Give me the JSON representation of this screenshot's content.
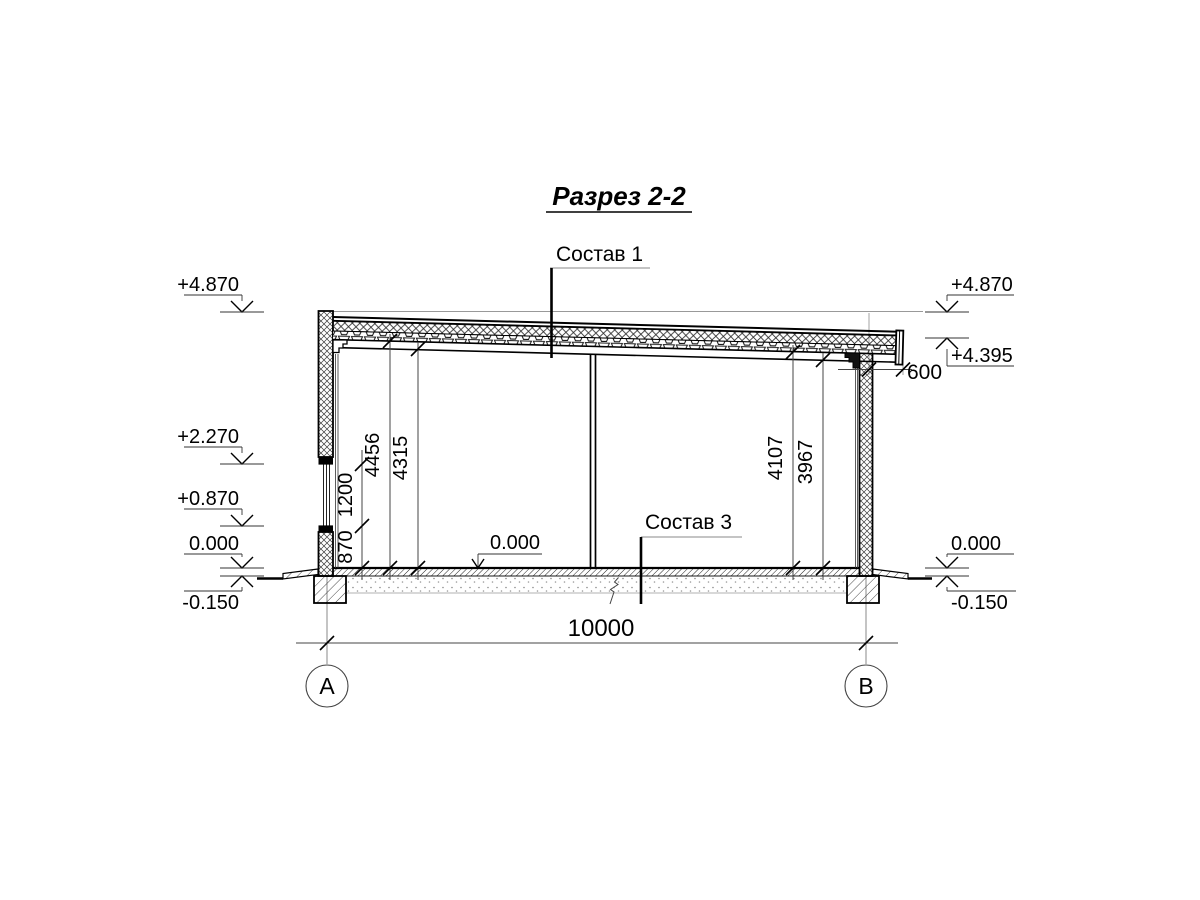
{
  "title": "Разрез 2-2",
  "callouts": {
    "roof_assembly": "Состав 1",
    "floor_assembly": "Состав 3"
  },
  "elevation_marks": {
    "left": [
      {
        "value": "+4.870"
      },
      {
        "value": "+2.270"
      },
      {
        "value": "+0.870"
      },
      {
        "value": "0.000"
      },
      {
        "value": "-0.150"
      }
    ],
    "right": [
      {
        "value": "+4.870"
      },
      {
        "value": "+4.395"
      },
      {
        "value": "0.000"
      },
      {
        "value": "-0.150"
      }
    ],
    "interior_floor": "0.000"
  },
  "dimensions": {
    "window_chain": [
      "870",
      "1200"
    ],
    "interior_heights_left": [
      "4456",
      "4315"
    ],
    "interior_heights_right": [
      "4107",
      "3967"
    ],
    "roof_overhang": "600",
    "overall_span": "10000"
  },
  "axes": {
    "left": "A",
    "right": "B"
  },
  "colors": {
    "ink": "#000000",
    "thin_line": "#888888",
    "background": "#ffffff"
  }
}
